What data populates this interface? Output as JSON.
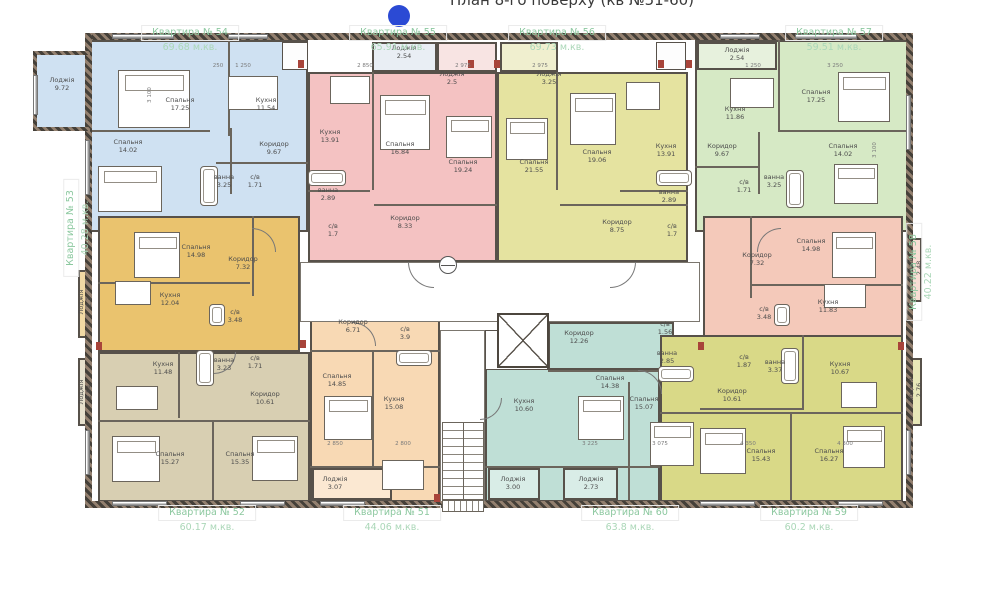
{
  "title": "План 8-го поверху (кв №51-60)",
  "marker_color": "#2b4ad4",
  "apartments": [
    {
      "id": "54",
      "name": "Квартира № 54",
      "area": "69.68 м.кв.",
      "color": "#cfe1f2",
      "label": {
        "x": 190,
        "y": 25,
        "rot": 0
      },
      "regions": [
        [
          88,
          40,
          220,
          192
        ],
        [
          35,
          53,
          55,
          77
        ]
      ],
      "rooms": [
        [
          "Спальня",
          "17.25",
          180,
          104
        ],
        [
          "Кухня",
          "11.54",
          266,
          104
        ],
        [
          "Спальня",
          "14.02",
          128,
          146
        ],
        [
          "Коридор",
          "9.67",
          274,
          148
        ],
        [
          "ванна",
          "3.25",
          224,
          181
        ],
        [
          "с/в",
          "1.71",
          255,
          181
        ],
        [
          "Лоджія",
          "9.72",
          62,
          84
        ]
      ]
    },
    {
      "id": "55",
      "name": "Квартира № 55",
      "area": "65.91 м.кв.",
      "color": "#f4c2c2",
      "label": {
        "x": 398,
        "y": 25,
        "rot": 0
      },
      "regions": [
        [
          308,
          72,
          189,
          190
        ],
        [
          372,
          42,
          65,
          30,
          "#e9eef4"
        ],
        [
          437,
          42,
          60,
          30,
          "#f8e4e3"
        ]
      ],
      "rooms": [
        [
          "Лоджія",
          "2.54",
          404,
          52
        ],
        [
          "Лоджія",
          "2.5",
          452,
          78
        ],
        [
          "Кухня",
          "13.91",
          330,
          136
        ],
        [
          "Спальня",
          "16.84",
          400,
          148
        ],
        [
          "Спальня",
          "19.24",
          463,
          166
        ],
        [
          "ванна",
          "2.89",
          328,
          194
        ],
        [
          "с/в",
          "1.7",
          333,
          230
        ],
        [
          "Коридор",
          "8.33",
          405,
          222
        ]
      ]
    },
    {
      "id": "56",
      "name": "Квартира № 56",
      "area": "69.73 м.кв.",
      "color": "#e5e3a0",
      "label": {
        "x": 557,
        "y": 25,
        "rot": 0
      },
      "regions": [
        [
          497,
          72,
          191,
          190
        ],
        [
          500,
          42,
          58,
          30,
          "#f0efcf"
        ]
      ],
      "rooms": [
        [
          "Лоджія",
          "3.25",
          549,
          78
        ],
        [
          "Спальня",
          "21.55",
          534,
          166
        ],
        [
          "Спальня",
          "19.06",
          597,
          156
        ],
        [
          "Кухня",
          "13.91",
          666,
          150
        ],
        [
          "Коридор",
          "8.75",
          617,
          226
        ],
        [
          "ванна",
          "2.89",
          669,
          196
        ],
        [
          "с/в",
          "1.7",
          672,
          230
        ]
      ]
    },
    {
      "id": "57",
      "name": "Квартира № 57",
      "area": "59.51 м.кв.",
      "color": "#d6e9c5",
      "label": {
        "x": 834,
        "y": 25,
        "rot": 0
      },
      "regions": [
        [
          695,
          40,
          215,
          192
        ],
        [
          697,
          42,
          80,
          28,
          "#e7f1dd"
        ]
      ],
      "rooms": [
        [
          "Лоджія",
          "2.54",
          737,
          54
        ],
        [
          "Кухня",
          "11.86",
          735,
          113
        ],
        [
          "Спальня",
          "17.25",
          816,
          96
        ],
        [
          "Спальня",
          "14.02",
          843,
          150
        ],
        [
          "Коридор",
          "9.67",
          722,
          150
        ],
        [
          "с/в",
          "1.71",
          744,
          186
        ],
        [
          "ванна",
          "3.25",
          774,
          181
        ]
      ]
    },
    {
      "id": "53",
      "name": "Квартира № 53",
      "area": "40.28 м.кв.",
      "color": "#eac36e",
      "label": {
        "x": 78,
        "y": 228,
        "rot": -90
      },
      "regions": [
        [
          98,
          216,
          202,
          136
        ],
        [
          78,
          270,
          14,
          68,
          "#f1d9a4"
        ]
      ],
      "rooms": [
        [
          "Спальня",
          "14.98",
          196,
          251
        ],
        [
          "Коридор",
          "7.32",
          243,
          263
        ],
        [
          "Кухня",
          "12.04",
          170,
          299
        ],
        [
          "с/в",
          "3.48",
          235,
          316
        ],
        [
          "Лоджія",
          "2.3",
          85,
          302,
          -90
        ]
      ]
    },
    {
      "id": "58",
      "name": "Квартира № 58",
      "area": "40.22 м.кв.",
      "color": "#f4c9ba",
      "label": {
        "x": 921,
        "y": 272,
        "rot": -90
      },
      "regions": [
        [
          703,
          216,
          200,
          136
        ],
        [
          908,
          238,
          14,
          64,
          "#f8ded4"
        ]
      ],
      "rooms": [
        [
          "Коридор",
          "7.32",
          757,
          259
        ],
        [
          "Спальня",
          "14.98",
          811,
          245
        ],
        [
          "Кухня",
          "11.83",
          828,
          306
        ],
        [
          "с/в",
          "3.48",
          764,
          313
        ],
        [
          "Лоджія",
          "2.48",
          915,
          268,
          -90
        ]
      ]
    },
    {
      "id": "52",
      "name": "Квартира № 52",
      "area": "60.17 м.кв.",
      "color": "#d8cfb2",
      "label": {
        "x": 207,
        "y": 505,
        "rot": 0
      },
      "regions": [
        [
          98,
          352,
          212,
          150
        ],
        [
          78,
          358,
          14,
          68,
          "#e6e0cc"
        ]
      ],
      "rooms": [
        [
          "Кухня",
          "11.48",
          163,
          368
        ],
        [
          "ванна",
          "3.23",
          224,
          364
        ],
        [
          "с/в",
          "1.71",
          255,
          362
        ],
        [
          "Коридор",
          "10.61",
          265,
          398
        ],
        [
          "Спальня",
          "15.27",
          170,
          458
        ],
        [
          "Спальня",
          "15.35",
          240,
          458
        ],
        [
          "Лоджія",
          "2.54",
          85,
          392,
          -90
        ]
      ]
    },
    {
      "id": "51",
      "name": "Квартира № 51",
      "area": "44.06 м.кв.",
      "color": "#f8d9b4",
      "label": {
        "x": 392,
        "y": 505,
        "rot": 0
      },
      "regions": [
        [
          310,
          300,
          130,
          202
        ],
        [
          312,
          468,
          80,
          32,
          "#fbe8d2"
        ]
      ],
      "rooms": [
        [
          "Коридор",
          "6.71",
          353,
          326
        ],
        [
          "с/в",
          "3.9",
          405,
          333
        ],
        [
          "Спальня",
          "14.85",
          337,
          380
        ],
        [
          "Кухня",
          "15.08",
          394,
          403
        ],
        [
          "Лоджія",
          "3.07",
          335,
          483
        ]
      ]
    },
    {
      "id": "60",
      "name": "Квартира № 60",
      "area": "63.8 м.кв.",
      "color": "#bfdfd6",
      "label": {
        "x": 630,
        "y": 505,
        "rot": 0
      },
      "regions": [
        [
          548,
          322,
          126,
          48
        ],
        [
          485,
          368,
          175,
          134
        ],
        [
          488,
          468,
          52,
          32,
          "#d9ede7"
        ],
        [
          563,
          468,
          55,
          32,
          "#d9ede7"
        ]
      ],
      "rooms": [
        [
          "Коридор",
          "12.26",
          579,
          337
        ],
        [
          "с/в",
          "1.56",
          665,
          328
        ],
        [
          "ванна",
          "2.85",
          667,
          357
        ],
        [
          "Спальня",
          "14.38",
          610,
          382
        ],
        [
          "Кухня",
          "10.60",
          524,
          405
        ],
        [
          "Спальня",
          "15.07",
          644,
          403
        ],
        [
          "Лоджія",
          "3.00",
          513,
          483
        ],
        [
          "Лоджія",
          "2.73",
          591,
          483
        ]
      ]
    },
    {
      "id": "59",
      "name": "Квартира № 59",
      "area": "60.2 м.кв.",
      "color": "#d9d987",
      "label": {
        "x": 809,
        "y": 505,
        "rot": 0
      },
      "regions": [
        [
          660,
          335,
          243,
          167
        ],
        [
          908,
          358,
          14,
          68,
          "#e8e8b8"
        ]
      ],
      "rooms": [
        [
          "с/в",
          "1.87",
          744,
          361
        ],
        [
          "ванна",
          "3.37",
          775,
          366
        ],
        [
          "Кухня",
          "10.67",
          840,
          368
        ],
        [
          "Коридор",
          "10.61",
          732,
          395
        ],
        [
          "Спальня",
          "15.43",
          761,
          455
        ],
        [
          "Спальня",
          "16.27",
          829,
          455
        ],
        [
          "Лоджія",
          "2.76",
          915,
          390,
          -90
        ]
      ]
    }
  ],
  "core": {
    "hall": [
      300,
      262,
      400,
      60
    ],
    "strip": [
      440,
      330,
      45,
      172
    ],
    "elevator": [
      497,
      313,
      52,
      55
    ],
    "stairs": [
      442,
      422,
      42,
      78
    ],
    "entry": [
      442,
      500,
      42,
      12
    ],
    "stamp": [
      439,
      256,
      18,
      18
    ]
  },
  "white_boxes": [
    [
      282,
      42,
      26,
      28
    ],
    [
      656,
      42,
      30,
      28
    ],
    [
      485,
      330,
      63,
      40
    ]
  ],
  "outer_walls": [
    [
      85,
      33,
      828,
      7
    ],
    [
      85,
      501,
      828,
      7
    ],
    [
      85,
      33,
      7,
      475
    ],
    [
      906,
      33,
      7,
      475
    ],
    [
      33,
      51,
      57,
      4
    ],
    [
      33,
      51,
      4,
      80
    ],
    [
      33,
      127,
      57,
      4
    ]
  ],
  "inner_walls": [
    [
      228,
      40,
      2,
      96
    ],
    [
      90,
      130,
      120,
      2
    ],
    [
      230,
      128,
      2,
      66
    ],
    [
      216,
      162,
      92,
      2
    ],
    [
      372,
      72,
      2,
      118
    ],
    [
      308,
      190,
      62,
      2
    ],
    [
      374,
      204,
      123,
      2
    ],
    [
      556,
      72,
      2,
      118
    ],
    [
      620,
      190,
      68,
      2
    ],
    [
      560,
      204,
      128,
      2
    ],
    [
      778,
      40,
      2,
      92
    ],
    [
      778,
      130,
      130,
      2
    ],
    [
      758,
      132,
      2,
      62
    ],
    [
      695,
      166,
      64,
      2
    ],
    [
      252,
      216,
      2,
      80
    ],
    [
      98,
      282,
      152,
      2
    ],
    [
      750,
      216,
      2,
      82
    ],
    [
      752,
      284,
      151,
      2
    ],
    [
      98,
      420,
      212,
      2
    ],
    [
      178,
      352,
      2,
      66
    ],
    [
      212,
      422,
      2,
      78
    ],
    [
      372,
      352,
      2,
      114
    ],
    [
      310,
      350,
      130,
      2
    ],
    [
      310,
      466,
      130,
      2
    ],
    [
      548,
      370,
      112,
      2
    ],
    [
      628,
      382,
      2,
      118
    ],
    [
      485,
      466,
      175,
      2
    ],
    [
      660,
      412,
      243,
      2
    ],
    [
      790,
      414,
      2,
      88
    ],
    [
      700,
      408,
      104,
      2
    ],
    [
      802,
      335,
      2,
      75
    ]
  ],
  "windows": [
    [
      112,
      34,
      62,
      "h"
    ],
    [
      228,
      34,
      40,
      "h"
    ],
    [
      720,
      34,
      40,
      "h"
    ],
    [
      795,
      34,
      62,
      "h"
    ],
    [
      112,
      501,
      55,
      "h"
    ],
    [
      240,
      501,
      45,
      "h"
    ],
    [
      320,
      501,
      45,
      "h"
    ],
    [
      700,
      501,
      55,
      "h"
    ],
    [
      838,
      501,
      45,
      "h"
    ],
    [
      85,
      140,
      55,
      "v"
    ],
    [
      85,
      430,
      45,
      "v"
    ],
    [
      906,
      95,
      55,
      "v"
    ],
    [
      906,
      430,
      45,
      "v"
    ],
    [
      33,
      75,
      40,
      "v"
    ]
  ],
  "red_marks": [
    [
      298,
      60
    ],
    [
      468,
      60
    ],
    [
      494,
      60
    ],
    [
      658,
      60
    ],
    [
      686,
      60
    ],
    [
      96,
      342
    ],
    [
      300,
      340
    ],
    [
      698,
      342
    ],
    [
      898,
      342
    ],
    [
      434,
      494
    ]
  ],
  "furniture": [
    [
      "bed",
      118,
      70,
      72,
      58
    ],
    [
      "bed",
      98,
      166,
      64,
      46
    ],
    [
      "bed",
      380,
      95,
      50,
      55
    ],
    [
      "bed",
      446,
      116,
      46,
      42
    ],
    [
      "bed",
      506,
      118,
      42,
      42
    ],
    [
      "bed",
      570,
      93,
      46,
      52
    ],
    [
      "bed",
      838,
      72,
      52,
      50
    ],
    [
      "bed",
      834,
      164,
      44,
      40
    ],
    [
      "bed",
      134,
      232,
      46,
      46
    ],
    [
      "bed",
      832,
      232,
      44,
      46
    ],
    [
      "bed",
      112,
      436,
      48,
      46
    ],
    [
      "bed",
      252,
      436,
      46,
      45
    ],
    [
      "bed",
      324,
      396,
      48,
      44
    ],
    [
      "bed",
      578,
      396,
      46,
      44
    ],
    [
      "bed",
      650,
      422,
      44,
      44
    ],
    [
      "bed",
      700,
      428,
      46,
      46
    ],
    [
      "bed",
      843,
      426,
      42,
      42
    ],
    [
      "table",
      228,
      76,
      50,
      34
    ],
    [
      "table",
      330,
      76,
      40,
      28
    ],
    [
      "table",
      626,
      82,
      34,
      28
    ],
    [
      "table",
      730,
      78,
      44,
      30
    ],
    [
      "table",
      115,
      281,
      36,
      24
    ],
    [
      "table",
      824,
      284,
      42,
      24
    ],
    [
      "table",
      116,
      386,
      42,
      24
    ],
    [
      "table",
      382,
      460,
      42,
      30
    ],
    [
      "table",
      841,
      382,
      36,
      26
    ],
    [
      "tub",
      200,
      166,
      18,
      40
    ],
    [
      "tub",
      308,
      170,
      38,
      16
    ],
    [
      "tub",
      656,
      170,
      36,
      16
    ],
    [
      "tub",
      786,
      170,
      18,
      38
    ],
    [
      "tub",
      209,
      304,
      16,
      22
    ],
    [
      "tub",
      774,
      304,
      16,
      22
    ],
    [
      "tub",
      196,
      350,
      18,
      36
    ],
    [
      "tub",
      396,
      350,
      36,
      16
    ],
    [
      "tub",
      658,
      366,
      36,
      16
    ],
    [
      "tub",
      781,
      348,
      18,
      36
    ]
  ],
  "arcs": [
    [
      408,
      262,
      26,
      "dl"
    ],
    [
      610,
      262,
      26,
      "dr"
    ],
    [
      252,
      228,
      24,
      "ur"
    ],
    [
      757,
      228,
      24,
      "ul"
    ],
    [
      352,
      322,
      24,
      "ur"
    ],
    [
      638,
      370,
      24,
      "ur"
    ],
    [
      480,
      398,
      22,
      "dr"
    ],
    [
      214,
      352,
      22,
      "dr"
    ]
  ],
  "dimensions": [
    [
      "250",
      218,
      66,
      0
    ],
    [
      "1 250",
      243,
      66,
      0
    ],
    [
      "2 850",
      365,
      66,
      0
    ],
    [
      "2 975",
      463,
      66,
      0
    ],
    [
      "2 975",
      540,
      66,
      0
    ],
    [
      "1 250",
      753,
      66,
      0
    ],
    [
      "3 250",
      835,
      66,
      0
    ],
    [
      "2 850",
      335,
      444,
      0
    ],
    [
      "2 800",
      403,
      444,
      0
    ],
    [
      "3 225",
      590,
      444,
      0
    ],
    [
      "3 075",
      660,
      444,
      0
    ],
    [
      "4 350",
      748,
      444,
      0
    ],
    [
      "4 300",
      845,
      444,
      0
    ],
    [
      "3 100",
      150,
      95,
      -90
    ],
    [
      "3 100",
      875,
      150,
      -90
    ]
  ]
}
